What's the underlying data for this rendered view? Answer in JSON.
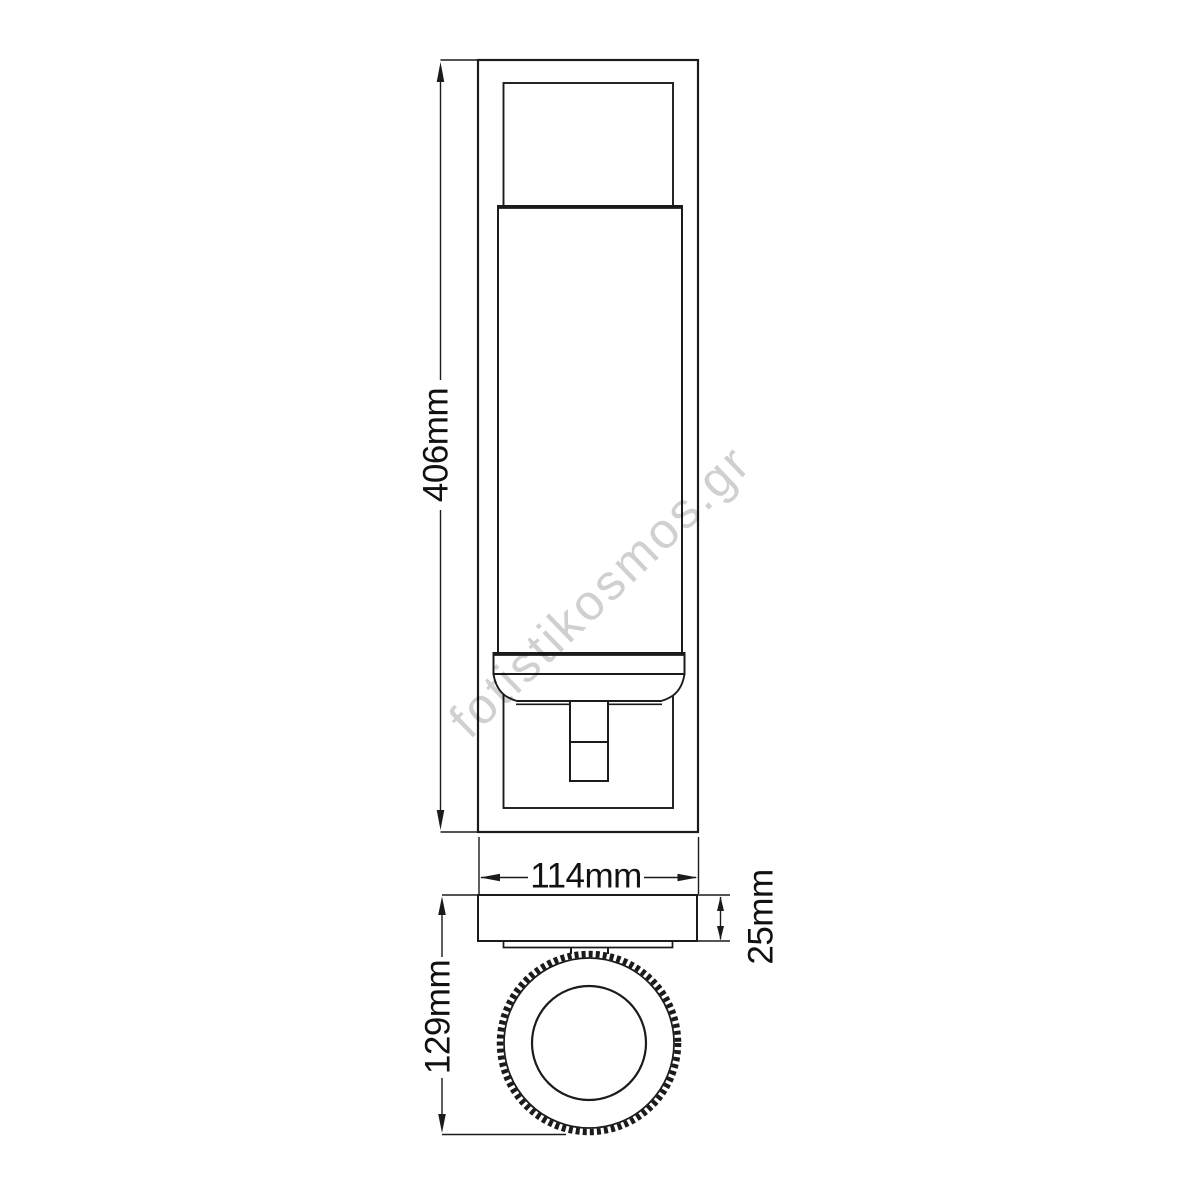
{
  "dimensions": {
    "height_label": "406mm",
    "width_label": "114mm",
    "projection_label": "129mm",
    "depth_label": "25mm"
  },
  "watermark": {
    "text": "fotistikosmos.gr"
  },
  "colors": {
    "background": "#ffffff",
    "line": "#1b1b1b",
    "dimension_text": "#111111",
    "watermark": "#d0d0d0"
  }
}
